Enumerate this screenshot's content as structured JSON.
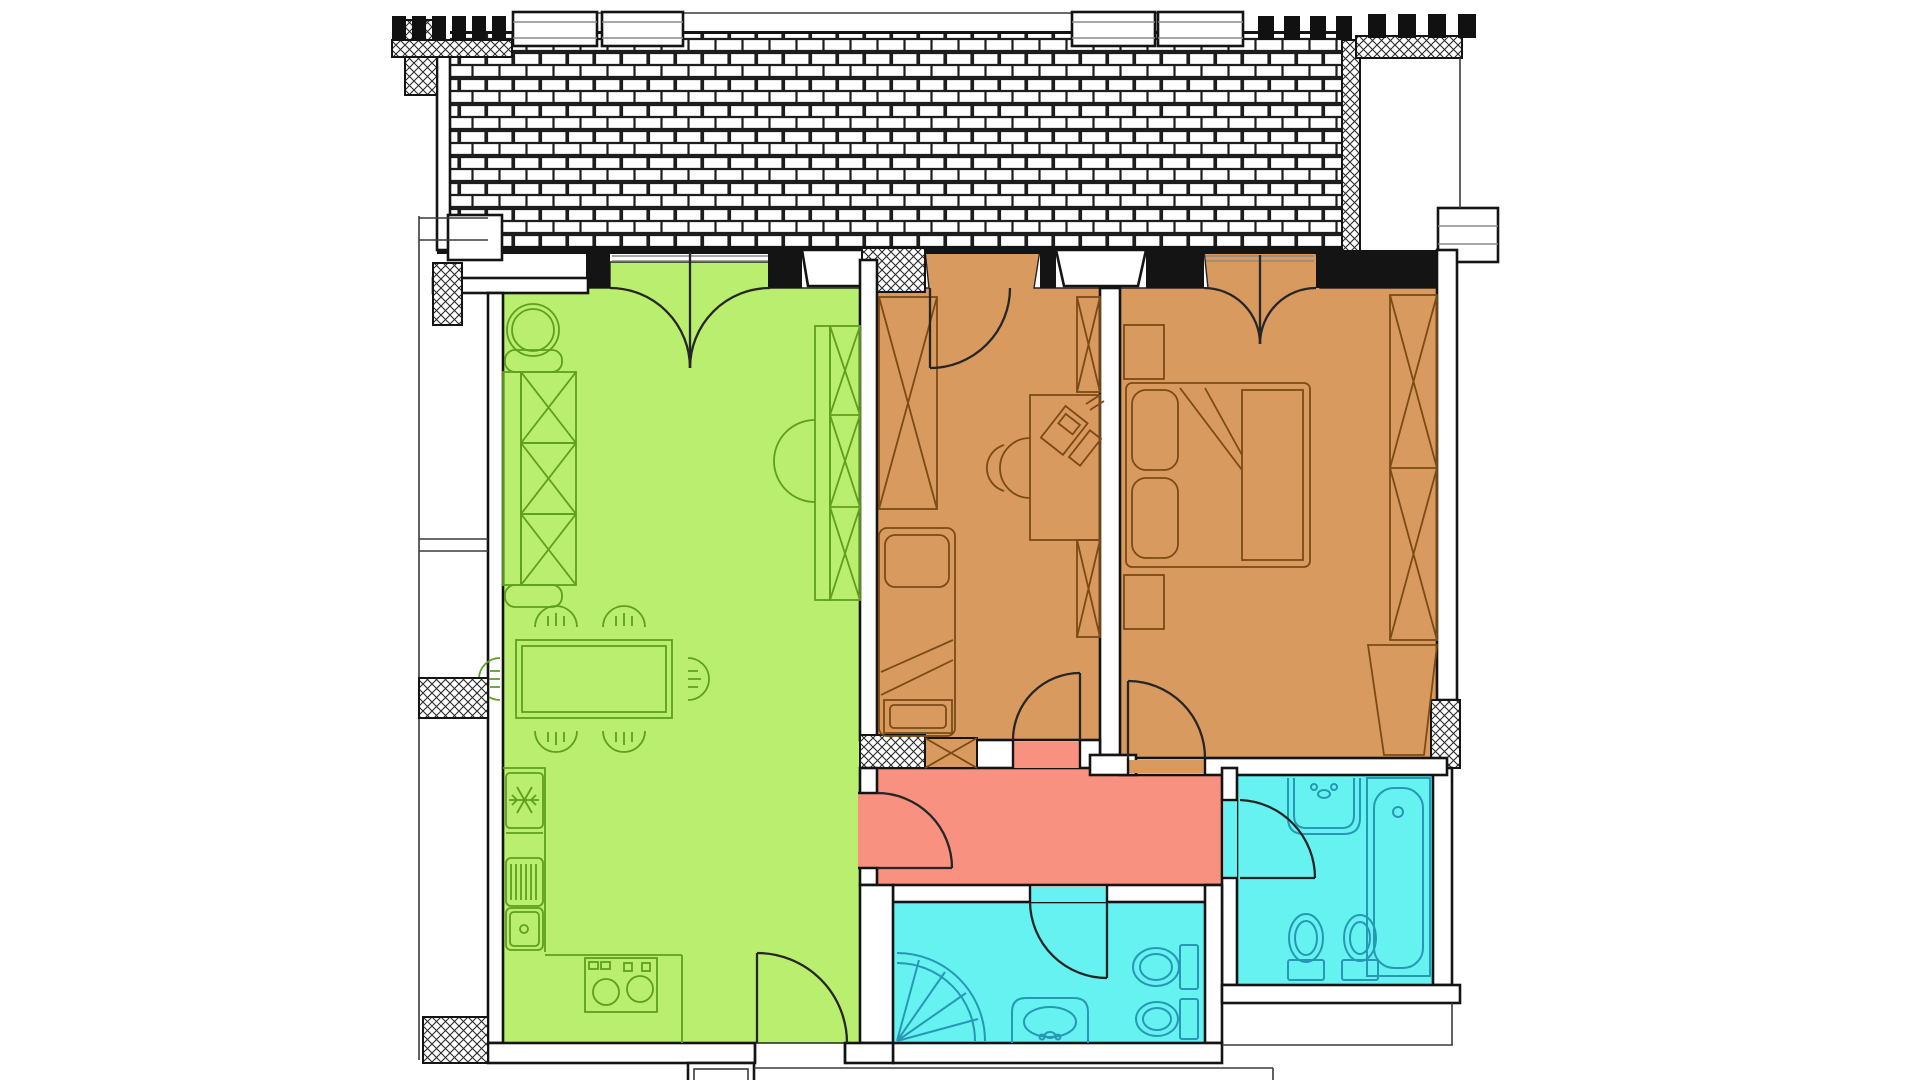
{
  "page": {
    "title": "Apartment floor plan drawing",
    "background": "#ffffff"
  },
  "colors": {
    "living_room": "#b9ee6e",
    "bedroom": "#d89a5f",
    "hallway": "#f8917f",
    "bathroom": "#66f2f1",
    "living_stroke": "#5f9e1e",
    "bedroom_stroke": "#7b4a15",
    "bathroom_stroke": "#2698b4",
    "door_arc": "#262626",
    "walls": "#141414",
    "brick_line": "#1d1d1d"
  },
  "rooms": [
    {
      "id": "terrace",
      "fill": "brick-paving",
      "features": [
        "brick-paving",
        "parapet-windows",
        "hatched-wall-columns"
      ]
    },
    {
      "id": "living-room-kitchen",
      "color_key": "living_room",
      "features": [
        "round-plant-table",
        "three-seat-sofa",
        "dining-table",
        "six-chairs",
        "tall-wardrobe",
        "fridge",
        "sink-with-drainer",
        "basin",
        "stove-two-burners",
        "terrace-double-door",
        "entrance-door",
        "hallway-door"
      ]
    },
    {
      "id": "bedroom-1",
      "color_key": "bedroom",
      "features": [
        "tall-wardrobe",
        "single-bed",
        "desk-with-laptop",
        "desk-chair",
        "two-shelf-columns",
        "terrace-door",
        "hallway-door"
      ]
    },
    {
      "id": "bedroom-2",
      "color_key": "bedroom",
      "features": [
        "double-bed",
        "two-pillows",
        "two-nightstands",
        "tall-wardrobe",
        "corner-cabinet",
        "terrace-double-door",
        "hallway-door"
      ]
    },
    {
      "id": "hallway",
      "color_key": "hallway",
      "features": [
        "four-door-openings"
      ]
    },
    {
      "id": "bathroom-right",
      "color_key": "bathroom",
      "features": [
        "washbasin",
        "bathtub",
        "toilet",
        "bidet",
        "door-from-hallway"
      ]
    },
    {
      "id": "bathroom-lower",
      "color_key": "bathroom",
      "features": [
        "corner-shower-fan",
        "washbasin",
        "toilet",
        "bidet",
        "door-from-hallway"
      ]
    }
  ]
}
